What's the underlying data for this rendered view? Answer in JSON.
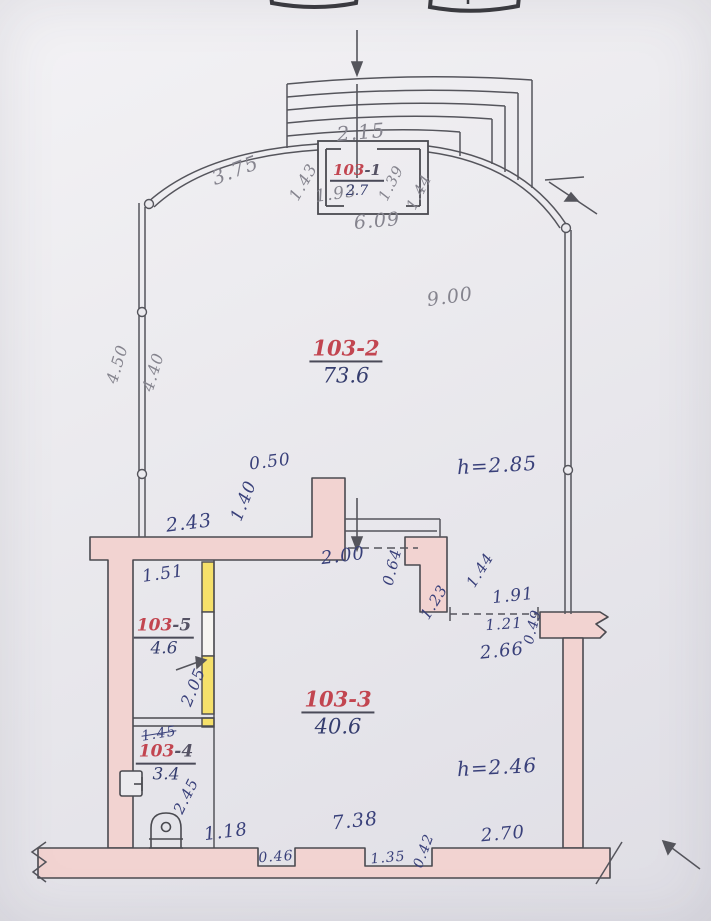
{
  "document": {
    "type": "hand-drawn floor plan, unit 103"
  },
  "colors": {
    "paper": "#ebeaee",
    "line": "#55555c",
    "wall_fill": "#f2d3d1",
    "partition_yellow": "#f5e06a",
    "ink_blue": "#39407a",
    "pencil_gray": "#85848e",
    "room_red": "#c24550"
  },
  "rooms": [
    {
      "prefix": "103",
      "suffix": "-1",
      "area": "2.7"
    },
    {
      "prefix": "103",
      "suffix": "-2",
      "area": "73.6"
    },
    {
      "prefix": "103",
      "suffix": "-3",
      "area": "40.6"
    },
    {
      "prefix": "103",
      "suffix": "-4",
      "area": "3.4"
    },
    {
      "prefix": "103",
      "suffix": "-5",
      "area": "4.6"
    }
  ],
  "heights": {
    "hall": "h=2.85",
    "lower": "h=2.46"
  },
  "dims": {
    "stair_width": "2.15",
    "vest_left": "1.43",
    "vest_opening": "1.93",
    "vest_right_in": "1.39",
    "vest_right_out": "1.44",
    "vest_total": "6.09",
    "curve_left": "3.75",
    "hall_width": "9.00",
    "wall_left_a": "4.50",
    "wall_left_b": "4.40",
    "stub_width": "0.50",
    "stub_height": "1.40",
    "wall_mid_left": "2.43",
    "room5_width": "1.51",
    "entry_opening": "2.00",
    "pier_a": "0.64",
    "pier_b": "1.23",
    "pier_c": "1.44",
    "door_gap": "1.91",
    "door_width": "1.21",
    "wall_end": "0.49",
    "wall_right_len": "2.66",
    "room5_height": "2.05",
    "room4_width_old": "1.45",
    "room4_height": "2.45",
    "bottom_a": "1.18",
    "niche_a": "0.46",
    "bottom_main": "7.38",
    "niche_b": "1.35",
    "niche_c": "0.42",
    "bottom_right": "2.70"
  },
  "symbols": {
    "toilet": "toilet-icon",
    "sink": "sink-icon",
    "stairs": "staircase",
    "entrance_arrow": "entrance-arrow-icon"
  }
}
